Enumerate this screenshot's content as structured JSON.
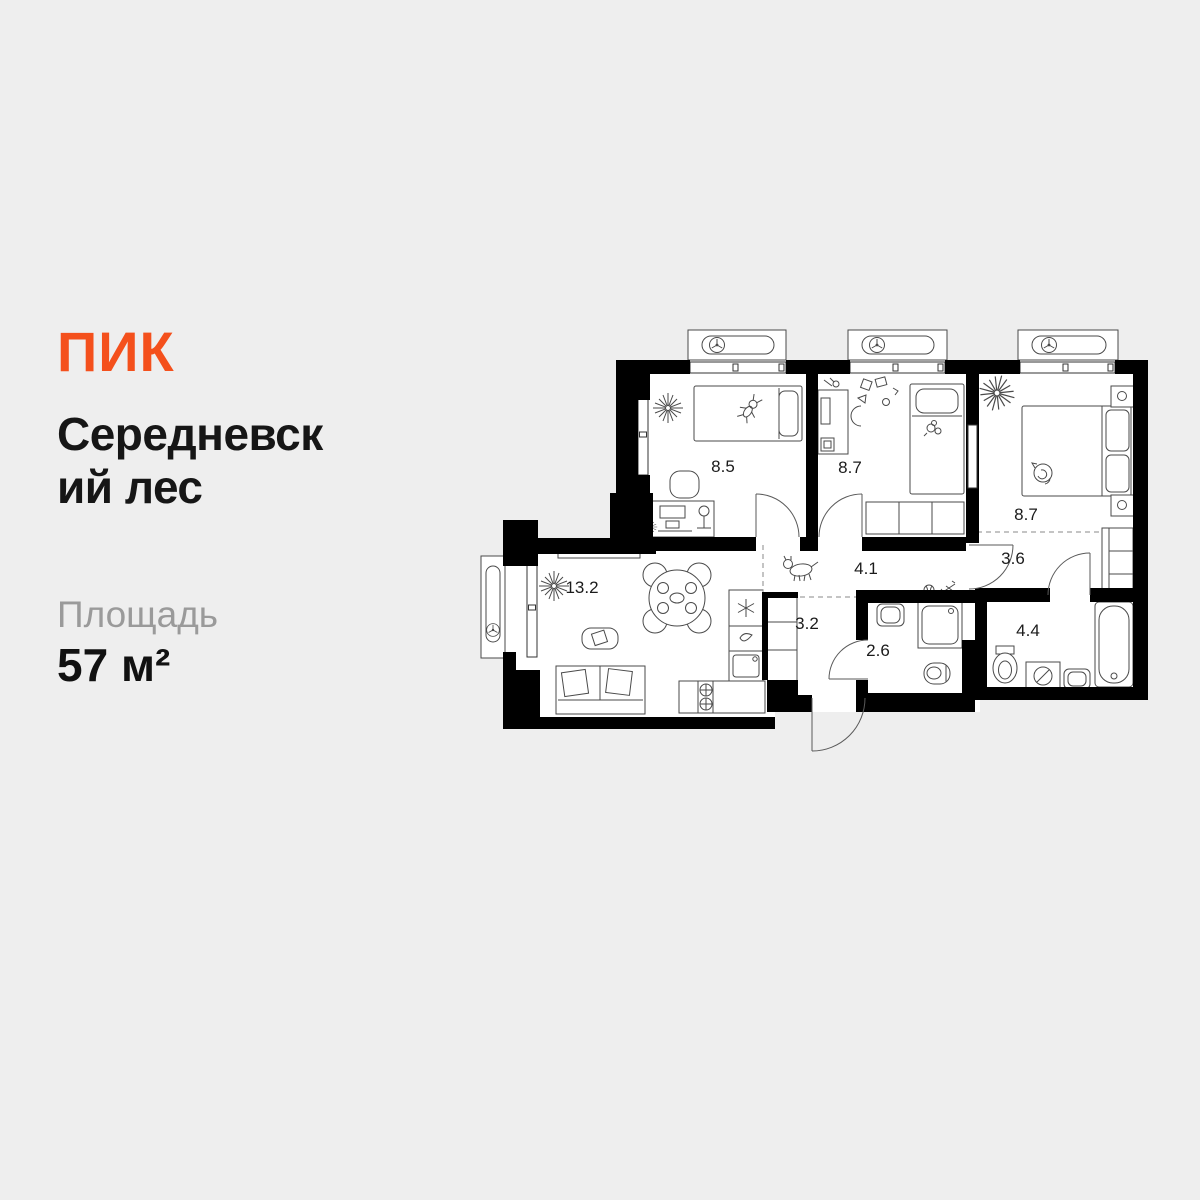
{
  "brand": {
    "logo_text": "ПИК",
    "logo_color": "#F4501C"
  },
  "project": {
    "title": "Середневский лес",
    "title_lines": [
      "Середневск",
      "ий лес"
    ]
  },
  "area": {
    "label": "Площадь",
    "value": "57 м²"
  },
  "colors": {
    "background": "#EEEEEE",
    "walls": "#000000",
    "accent": "#F4501C",
    "muted_text": "#9A9A9A",
    "text": "#151515",
    "furniture_line": "#4A4A4A"
  },
  "floor_plan": {
    "total_area_m2": 57,
    "rooms": [
      {
        "name": "bedroom-1",
        "area": "8.5"
      },
      {
        "name": "bedroom-2",
        "area": "8.7"
      },
      {
        "name": "bedroom-3",
        "area": "8.7"
      },
      {
        "name": "hallway",
        "area": "4.1"
      },
      {
        "name": "vestibule",
        "area": "3.6"
      },
      {
        "name": "living-kitchen",
        "area": "13.2"
      },
      {
        "name": "kitchen-niche",
        "area": "3.2"
      },
      {
        "name": "wc",
        "area": "2.6"
      },
      {
        "name": "bathroom",
        "area": "4.4"
      }
    ]
  }
}
